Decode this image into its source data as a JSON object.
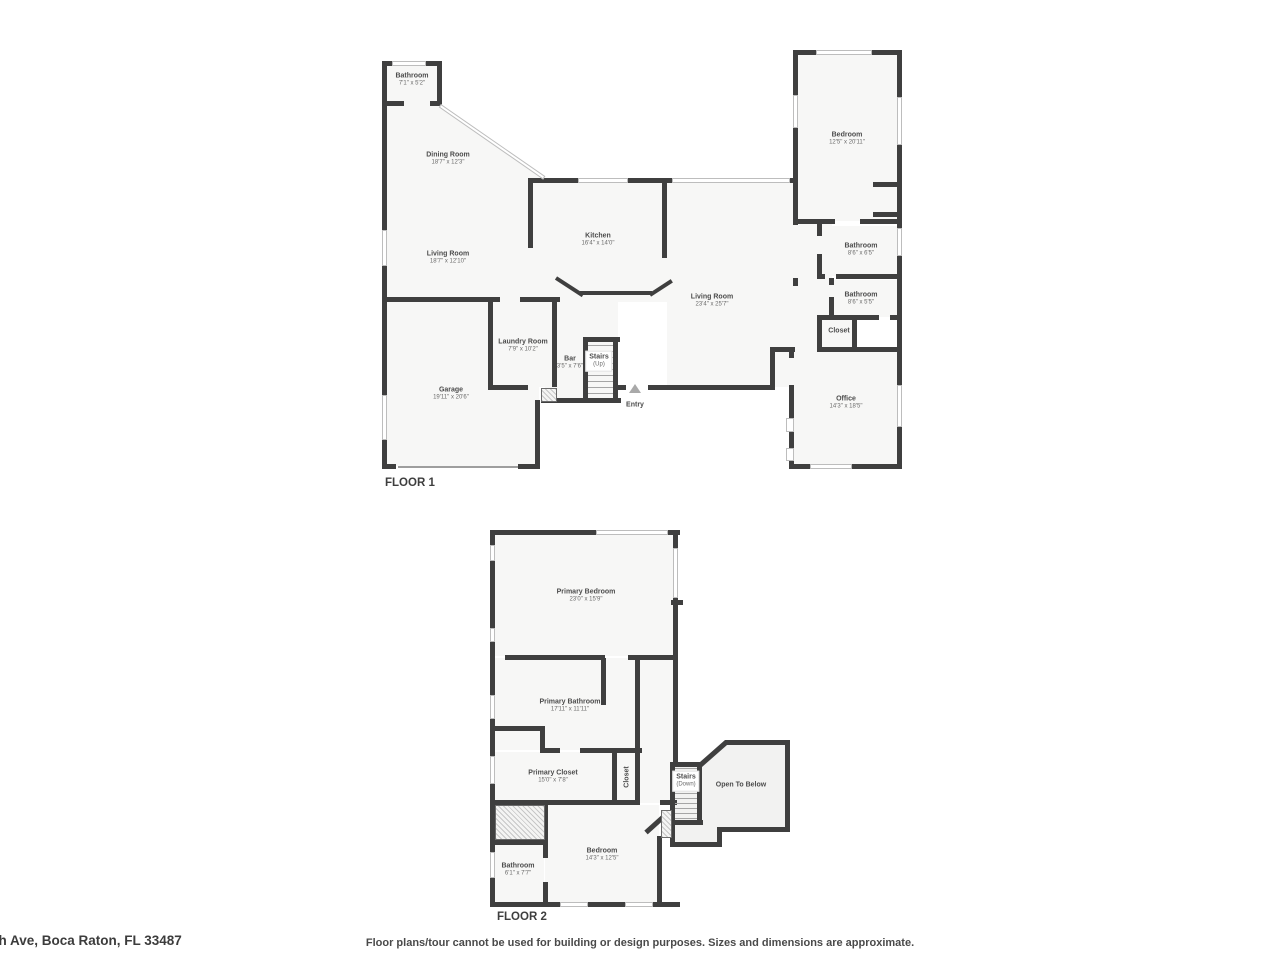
{
  "floor1": {
    "title": "FLOOR 1",
    "rooms": {
      "bathroom_tl": {
        "name": "Bathroom",
        "dims": "7'1\" x 5'2\""
      },
      "dining": {
        "name": "Dining Room",
        "dims": "18'7\" x 12'3\""
      },
      "living_left": {
        "name": "Living Room",
        "dims": "18'7\" x 12'10\""
      },
      "kitchen": {
        "name": "Kitchen",
        "dims": "16'4\" x 14'0\""
      },
      "living_right": {
        "name": "Living Room",
        "dims": "23'4\" x 25'7\""
      },
      "bedroom": {
        "name": "Bedroom",
        "dims": "12'5\" x 20'11\""
      },
      "bathroom_r1": {
        "name": "Bathroom",
        "dims": "8'6\" x 6'5\""
      },
      "bathroom_r2": {
        "name": "Bathroom",
        "dims": "8'6\" x 5'5\""
      },
      "closet": {
        "name": "Closet"
      },
      "office": {
        "name": "Office",
        "dims": "14'3\" x 18'5\""
      },
      "laundry": {
        "name": "Laundry Room",
        "dims": "7'9\" x 10'2\""
      },
      "bar": {
        "name": "Bar",
        "dims": "3'5\" x 7'6\""
      },
      "stairs": {
        "name": "Stairs",
        "sub": "(Up)"
      },
      "entry": {
        "name": "Entry"
      },
      "garage": {
        "name": "Garage",
        "dims": "19'11\" x 20'6\""
      }
    }
  },
  "floor2": {
    "title": "FLOOR 2",
    "rooms": {
      "primary_bedroom": {
        "name": "Primary Bedroom",
        "dims": "23'0\" x 15'9\""
      },
      "primary_bathroom": {
        "name": "Primary Bathroom",
        "dims": "17'11\" x 11'11\""
      },
      "primary_closet": {
        "name": "Primary Closet",
        "dims": "15'0\" x 7'8\""
      },
      "closet": {
        "name": "Closet"
      },
      "stairs": {
        "name": "Stairs",
        "sub": "(Down)"
      },
      "open_below": {
        "name": "Open To Below"
      },
      "bedroom": {
        "name": "Bedroom",
        "dims": "14'3\" x 12'5\""
      },
      "bathroom": {
        "name": "Bathroom",
        "dims": "6'1\" x 7'7\""
      }
    }
  },
  "footer": {
    "address": "th Ave, Boca Raton, FL 33487",
    "disclaimer": "Floor plans/tour cannot be used for building or design purposes. Sizes and dimensions are approximate."
  },
  "colors": {
    "wall": "#3f3f3f",
    "floor": "#f7f7f6",
    "open_area": "#f2f2f1",
    "label": "#4c4c4c"
  }
}
